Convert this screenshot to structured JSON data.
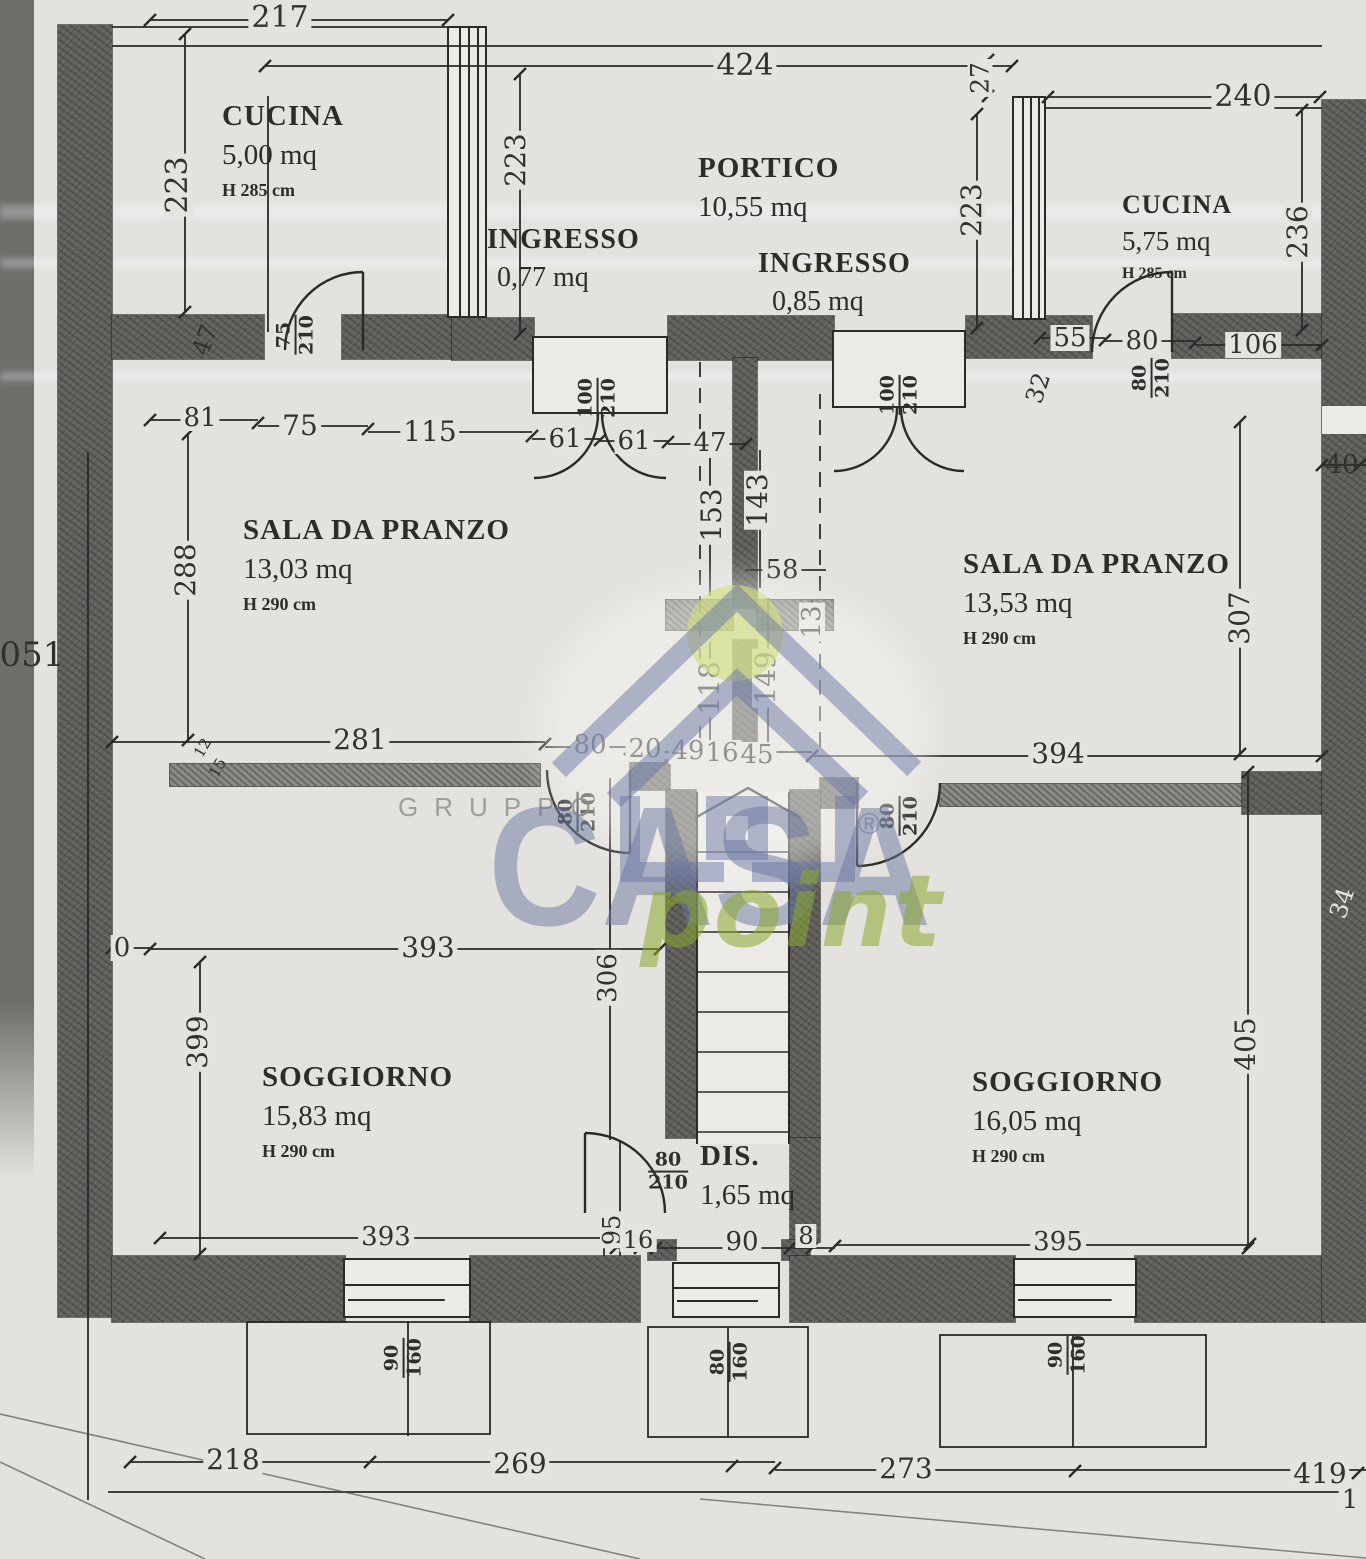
{
  "rooms": {
    "cucina_sx": {
      "name": "CUCINA",
      "area": "5,00 mq",
      "h": "H 285 cm"
    },
    "portico": {
      "name": "PORTICO",
      "area": "10,55 mq"
    },
    "ingresso_sx": {
      "name": "INGRESSO",
      "area": "0,77 mq"
    },
    "ingresso_dx": {
      "name": "INGRESSO",
      "area": "0,85 mq"
    },
    "cucina_dx": {
      "name": "CUCINA",
      "area": "5,75 mq",
      "h": "H 285 cm"
    },
    "sala_sx": {
      "name": "SALA DA PRANZO",
      "area": "13,03 mq",
      "h": "H 290 cm"
    },
    "sala_dx": {
      "name": "SALA DA PRANZO",
      "area": "13,53 mq",
      "h": "H 290 cm"
    },
    "soggiorno_sx": {
      "name": "SOGGIORNO",
      "area": "15,83 mq",
      "h": "H 290 cm"
    },
    "soggiorno_dx": {
      "name": "SOGGIORNO",
      "area": "16,05 mq",
      "h": "H 290 cm"
    },
    "dis": {
      "name": "DIS.",
      "area": "1,65 mq"
    }
  },
  "dims": {
    "d217": "217",
    "d424": "424",
    "d240": "240",
    "d27": "27",
    "d223a": "223",
    "d223b": "223",
    "d223c": "223",
    "d236": "236",
    "d47a": "47",
    "d81": "81",
    "d75": "75",
    "d115": "115",
    "d61a": "61",
    "d61b": "61",
    "d47b": "47",
    "d55": "55",
    "d80k": "80",
    "d106": "106",
    "d32": "32",
    "d288": "288",
    "d153": "153",
    "d143": "143",
    "d58": "58",
    "d13": "13",
    "d118": "118",
    "d149": "149",
    "d307": "307",
    "d40": "40",
    "d281": "281",
    "d80a": "80",
    "d20": "20",
    "d49": "49",
    "d16a": "16",
    "d45": "45",
    "d394": "394",
    "d12": "12",
    "d15": "15",
    "d0": "0",
    "d393a": "393",
    "d306": "306",
    "d399": "399",
    "d405": "405",
    "d34": "34",
    "d393b": "393",
    "d95": "95",
    "d16b": "16",
    "d90a": "90",
    "d8": "8",
    "d395": "395",
    "d218": "218",
    "d269": "269",
    "d273": "273",
    "d419": "419",
    "d1": "1",
    "d051": "051"
  },
  "doors": {
    "k_sx": {
      "w": "75",
      "h": "210"
    },
    "in_sx": {
      "w": "100",
      "h": "210"
    },
    "in_dx": {
      "w": "100",
      "h": "210"
    },
    "k_dx": {
      "w": "80",
      "h": "210"
    },
    "sog_sx": {
      "w": "80",
      "h": "210"
    },
    "sog_dx": {
      "w": "80",
      "h": "210"
    },
    "dis": {
      "w": "80",
      "h": "210"
    }
  },
  "windows": {
    "sx": {
      "w": "90",
      "h": "160"
    },
    "c": {
      "w": "80",
      "h": "160"
    },
    "dx": {
      "w": "90",
      "h": "160"
    }
  },
  "watermark": {
    "gruppo": "GRUPPO",
    "casa": "CASA",
    "point": "point",
    "reg": "®"
  }
}
